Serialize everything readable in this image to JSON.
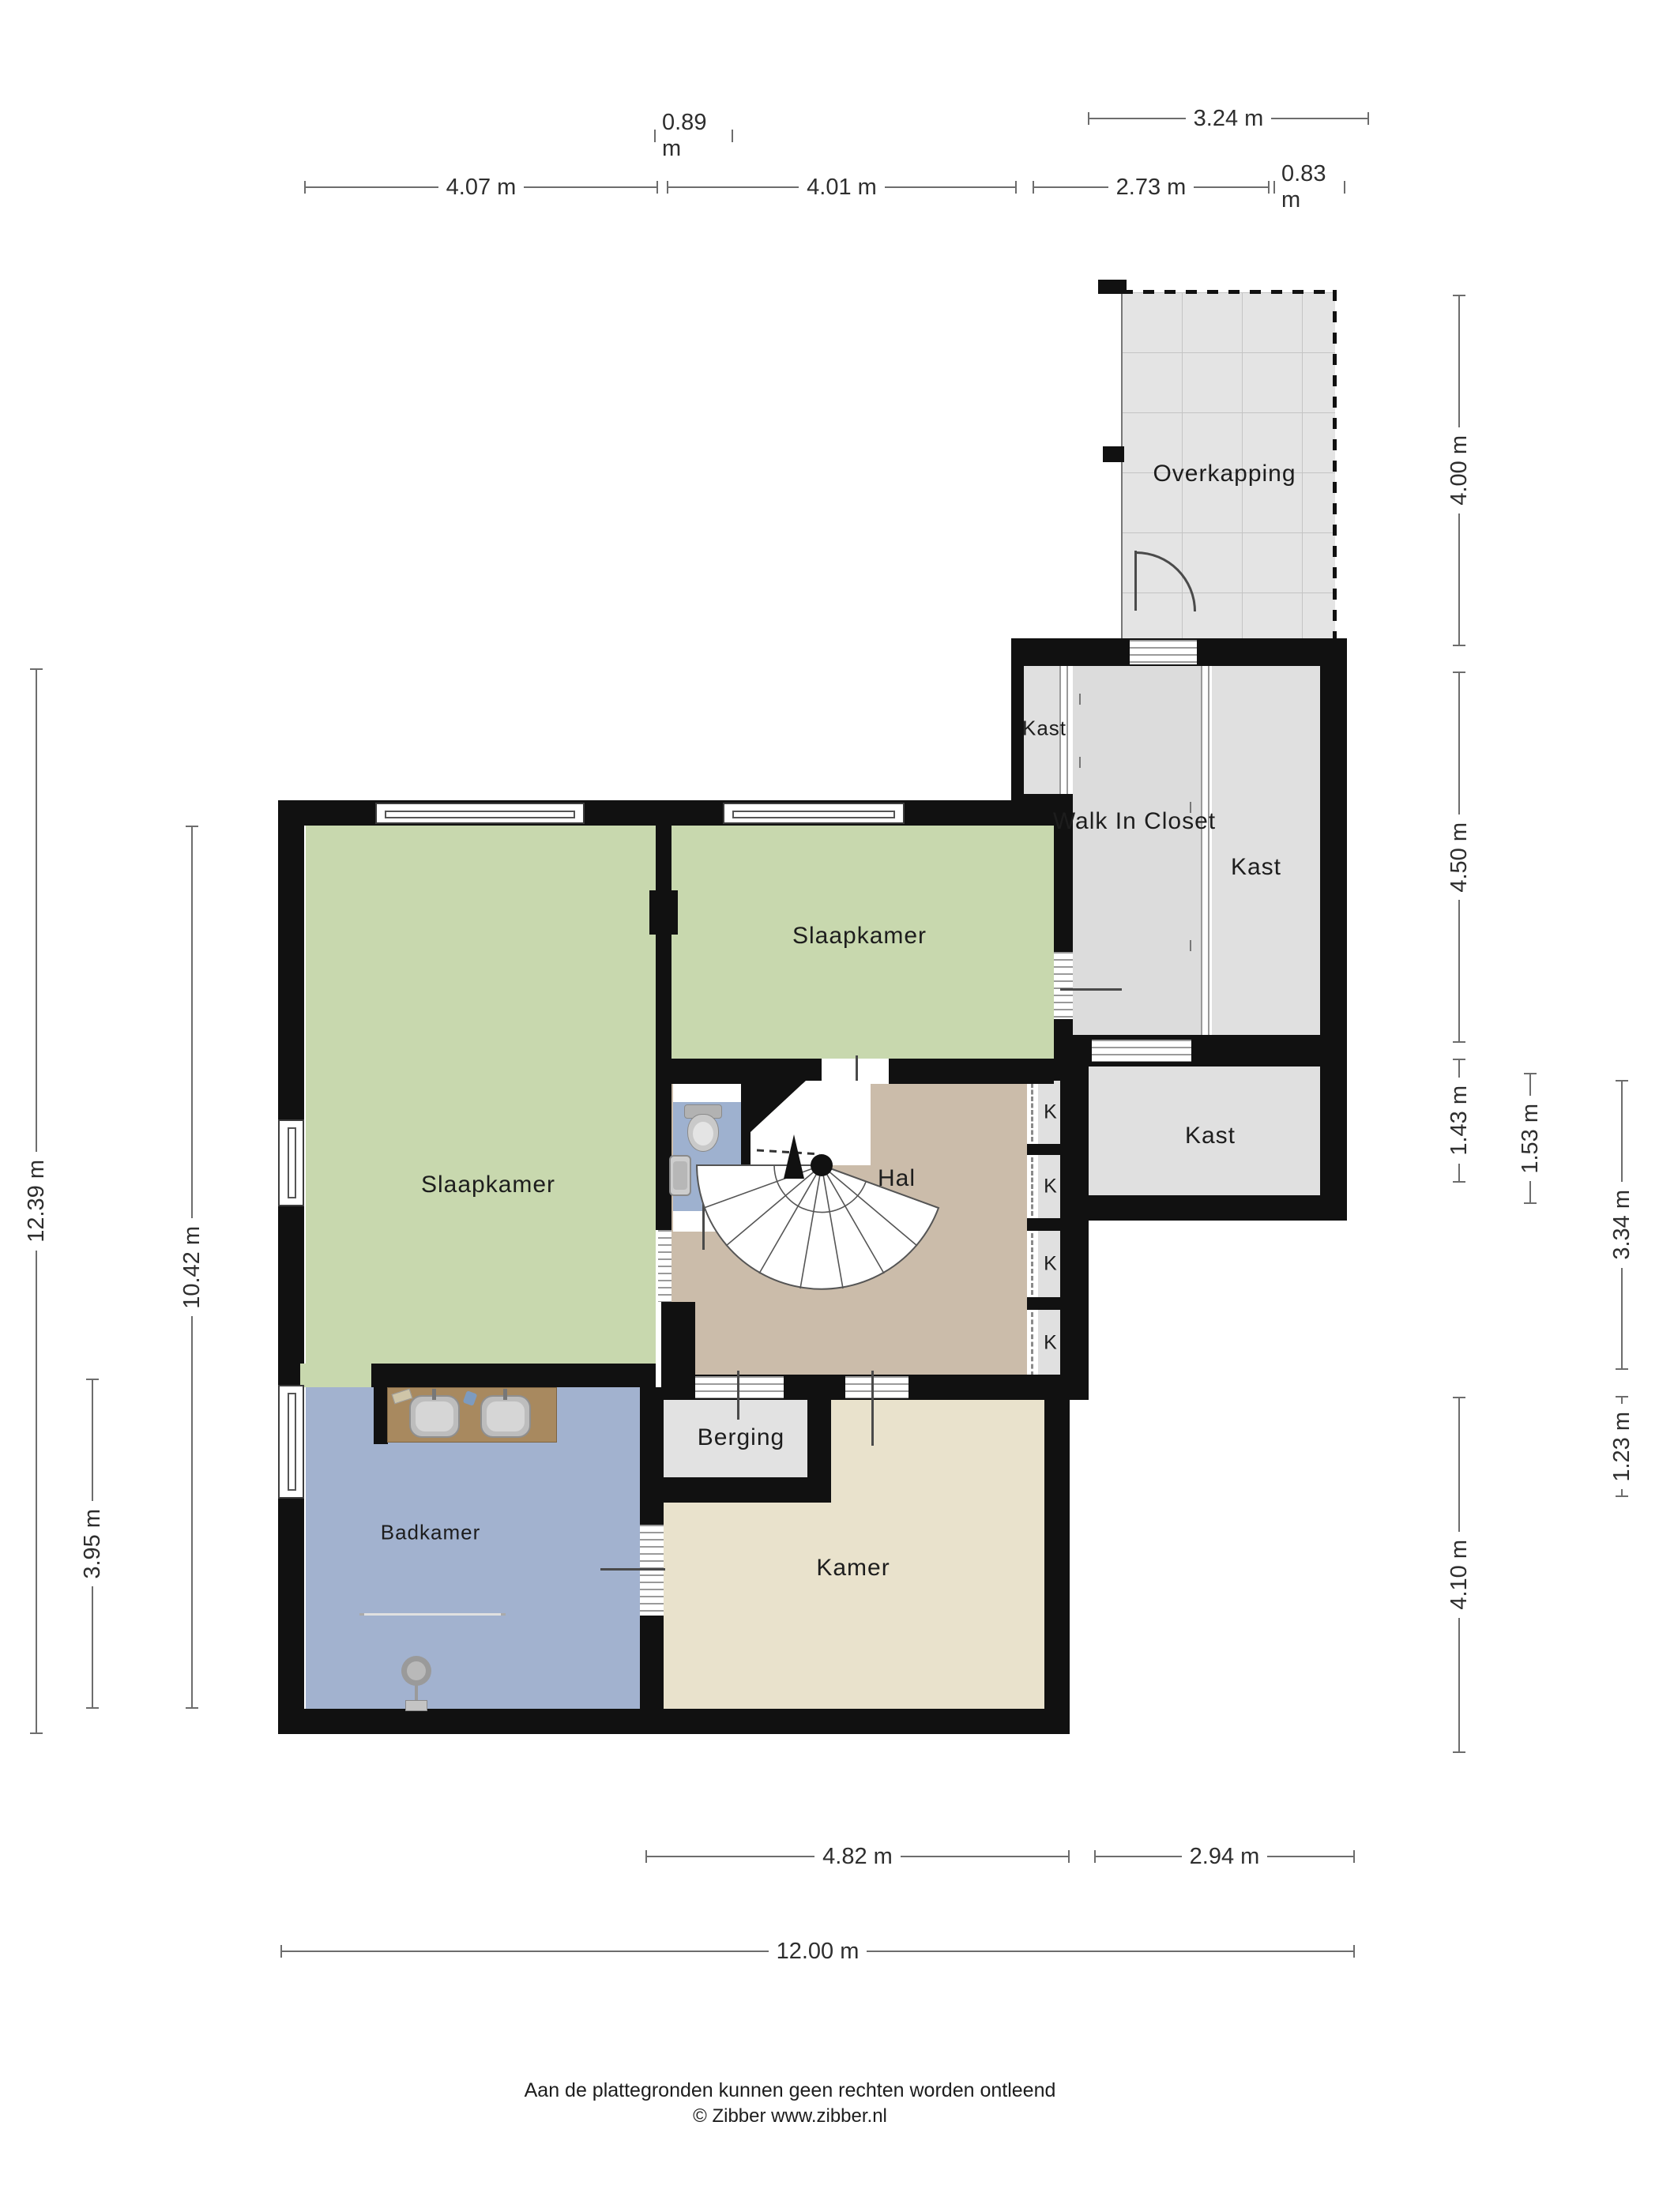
{
  "plan": {
    "type": "floorplan",
    "language": "nl"
  },
  "rooms": {
    "overkapping": "Overkapping",
    "kast_small": "Kast",
    "walk_in_closet": "Walk In Closet",
    "kast_right": "Kast",
    "kast_lower": "Kast",
    "slaapkamer_left": "Slaapkamer",
    "slaapkamer_top": "Slaapkamer",
    "hal": "Hal",
    "berging": "Berging",
    "kamer": "Kamer",
    "badkamer": "Badkamer",
    "k1": "K",
    "k2": "K",
    "k3": "K",
    "k4": "K"
  },
  "dims": {
    "t_089": "0.89 m",
    "t_324": "3.24 m",
    "t_407": "4.07 m",
    "t_401": "4.01 m",
    "t_273": "2.73 m",
    "t_083": "0.83 m",
    "l_1239": "12.39 m",
    "l_1042": "10.42 m",
    "l_395": "3.95 m",
    "r_400": "4.00 m",
    "r_450": "4.50 m",
    "r_143": "1.43 m",
    "r_153": "1.53 m",
    "r_334": "3.34 m",
    "r_123": "1.23 m",
    "r_410": "4.10 m",
    "b_482": "4.82 m",
    "b_294": "2.94 m",
    "b_1200": "12.00 m"
  },
  "footer": {
    "line1": "Aan de plattegronden kunnen geen rechten worden ontleend",
    "line2": "© Zibber www.zibber.nl"
  },
  "colors": {
    "wall": "#111111",
    "bedroom_green": "#c8d8ae",
    "hal_tan": "#cbbcaa",
    "badkamer_blue": "#a2b2cf",
    "toilet_blue": "#9eb1cf",
    "kamer_beige": "#e9e2cc",
    "storage_gray": "#e2e2e2",
    "closet_gray": "#dcdcdc",
    "overkapping_gray": "#e4e4e4",
    "vanity_wood": "#a8895f"
  }
}
